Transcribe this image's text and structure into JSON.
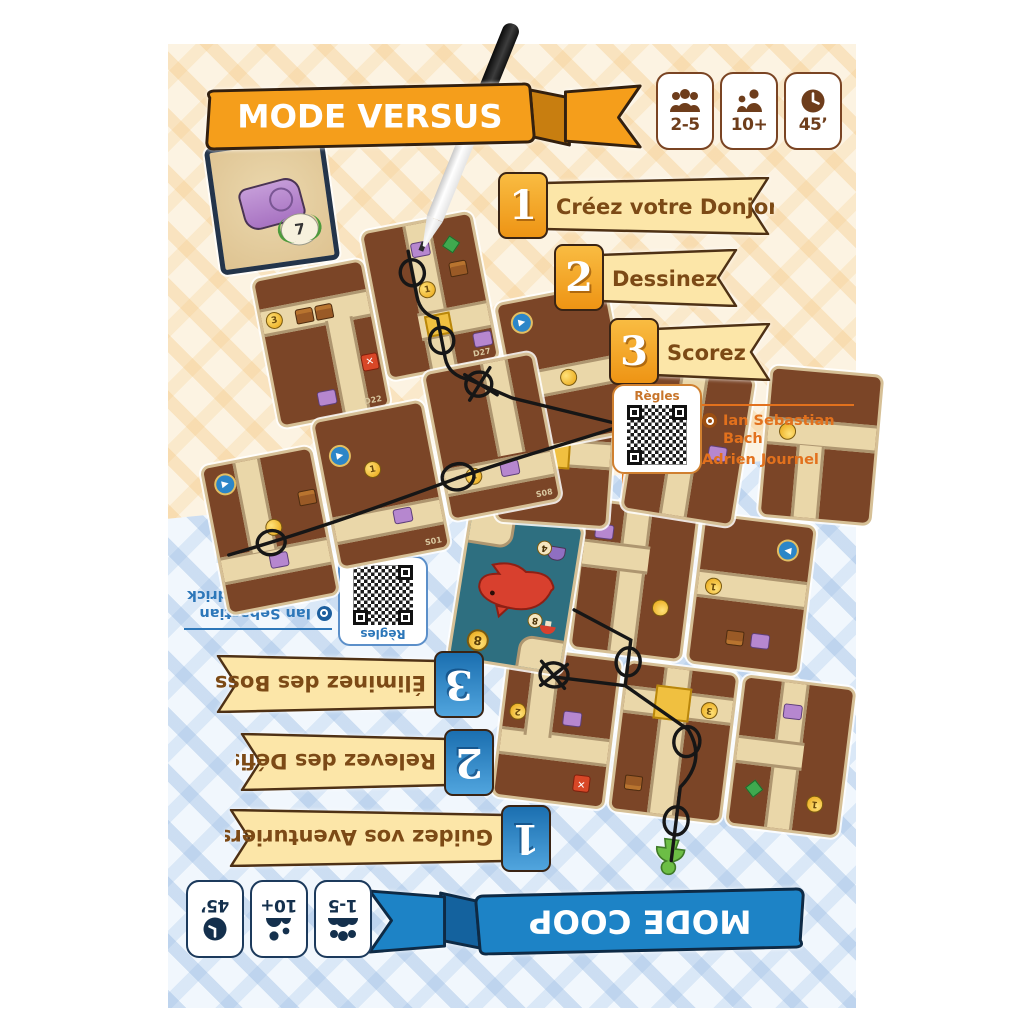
{
  "versus": {
    "banner": "MODE VERSUS",
    "theme_color": "#F59E1B",
    "badges": [
      {
        "icon": "players-icon",
        "label": "2-5"
      },
      {
        "icon": "age-icon",
        "label": "10+"
      },
      {
        "icon": "time-icon",
        "label": "45’"
      }
    ],
    "steps": [
      {
        "number": "1",
        "label": "Créez votre Donjon"
      },
      {
        "number": "2",
        "label": "Dessinez"
      },
      {
        "number": "3",
        "label": "Scorez"
      }
    ],
    "rules_label": "Règles",
    "credits": [
      {
        "icon": "designer-icon",
        "name": "Ian Sebastian Bach"
      },
      {
        "icon": "illustrator-icon",
        "name": "Adrien Journel"
      }
    ],
    "tile_labels": [
      "D22",
      "D27",
      "S08",
      "S01"
    ],
    "coin_values": [
      "3",
      "1",
      "1",
      "1"
    ],
    "score_card": {
      "laurel_value": "7"
    }
  },
  "coop": {
    "banner": "MODE COOP",
    "theme_color": "#1D83C6",
    "badges": [
      {
        "icon": "players-icon",
        "label": "1-5"
      },
      {
        "icon": "age-icon",
        "label": "10+"
      },
      {
        "icon": "time-icon",
        "label": "45’"
      }
    ],
    "steps": [
      {
        "number": "1",
        "label": "Guidez vos Aventuriers"
      },
      {
        "number": "2",
        "label": "Relevez des Défis"
      },
      {
        "number": "3",
        "label": "Éliminez des Boss"
      }
    ],
    "rules_label": "Règles",
    "credits": [
      {
        "icon": "designer-icon",
        "name": "Ian Sebastian Bach & Cédrick Caumont"
      },
      {
        "icon": "illustrator-icon",
        "name": "Adrien Journel"
      }
    ],
    "coin_values": [
      "1",
      "3",
      "2",
      "1"
    ],
    "boss_card": {
      "coin_value": "8",
      "challenge_value": "8",
      "helmet_value": "4"
    }
  }
}
